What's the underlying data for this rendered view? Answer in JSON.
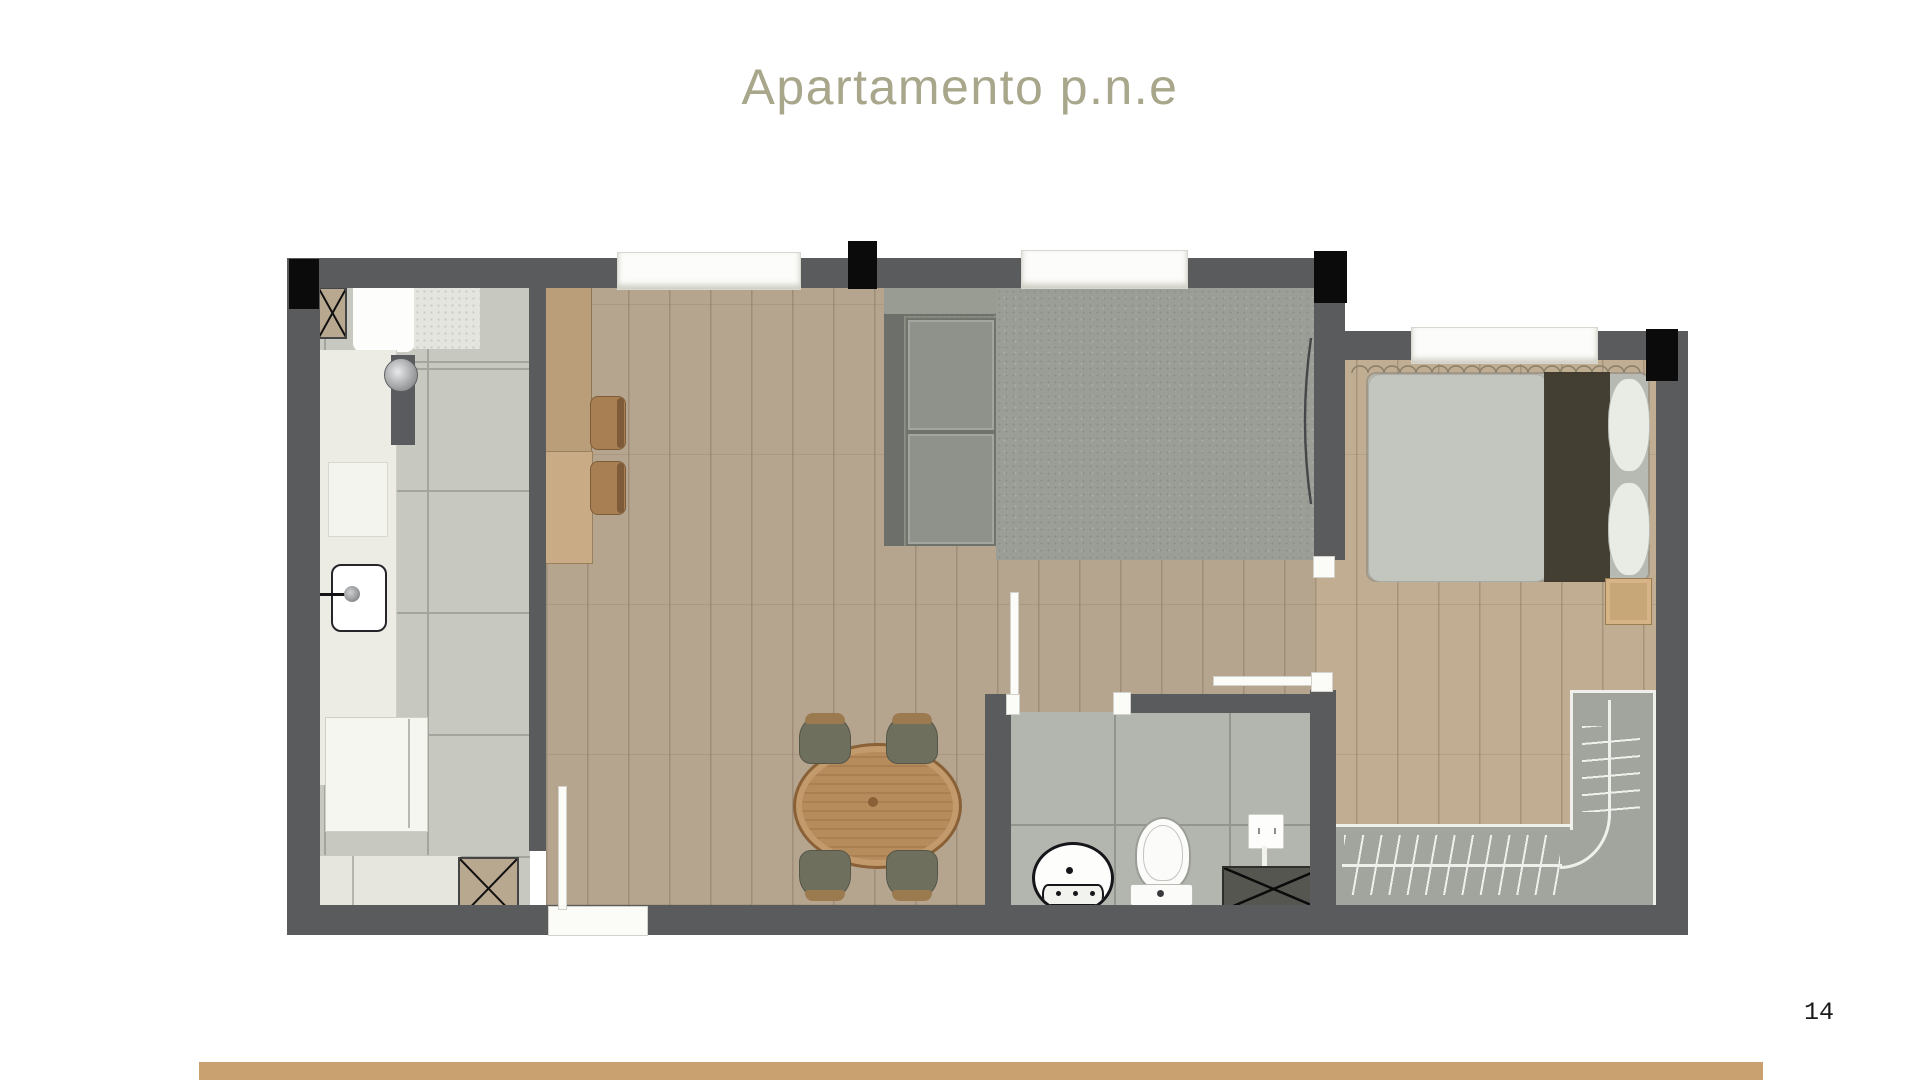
{
  "page": {
    "title": "Apartamento p.n.e",
    "page_number": "14"
  },
  "colors": {
    "accent_title": "#a8a68b",
    "page_number": "#1a1a1a",
    "footer_bar": "#c9a171",
    "wall": "#5a5b5d",
    "column": "#0b0b0b",
    "wood_floor": "#b5a48e",
    "bedroom_floor": "#c0ad92",
    "kitchen_tile": "#c7c9c1",
    "tile_grout": "#a3a59f",
    "bath_tile": "#b3b5af",
    "bath_grout": "#93958f",
    "rug": "#9b9e96",
    "counter": "#ecece4",
    "cabinet_wood": "#b99e79",
    "sofa": "#84877e",
    "bed_duvet": "#b7b9b3",
    "bed_runner": "#3a3428",
    "pillow": "#e9ebe5",
    "closet": "#a2a49e",
    "closet_line": "#eff0ec",
    "table_wood": "#b78c5c",
    "chair": "#6e6f5d",
    "chair_cap": "#9b7a50",
    "stool": "#a87f52",
    "shaft": "#b9a890"
  },
  "floor_plan": {
    "type": "apartment-floor-plan",
    "rooms": [
      {
        "name": "kitchen",
        "elements": [
          "service-shaft",
          "basin-with-drainer",
          "counter",
          "cooktop",
          "sink",
          "fridge",
          "lower-cabinet",
          "service-shaft-2",
          "breakfast-bar",
          "bar-stools"
        ]
      },
      {
        "name": "living-dining",
        "elements": [
          "sofa",
          "rug",
          "dining-table",
          "dining-chairs",
          "entry-door",
          "windows"
        ]
      },
      {
        "name": "bathroom",
        "elements": [
          "swing-door",
          "round-washbasin",
          "toilet",
          "shower-valve",
          "shower-bench"
        ]
      },
      {
        "name": "bedroom",
        "elements": [
          "window",
          "double-bed",
          "pillows",
          "bed-runner",
          "nightstand",
          "l-shaped-wardrobe",
          "sliding-door",
          "curtain-valance"
        ]
      }
    ],
    "structure": [
      "exterior-walls",
      "four-structural-columns",
      "three-windows"
    ]
  }
}
